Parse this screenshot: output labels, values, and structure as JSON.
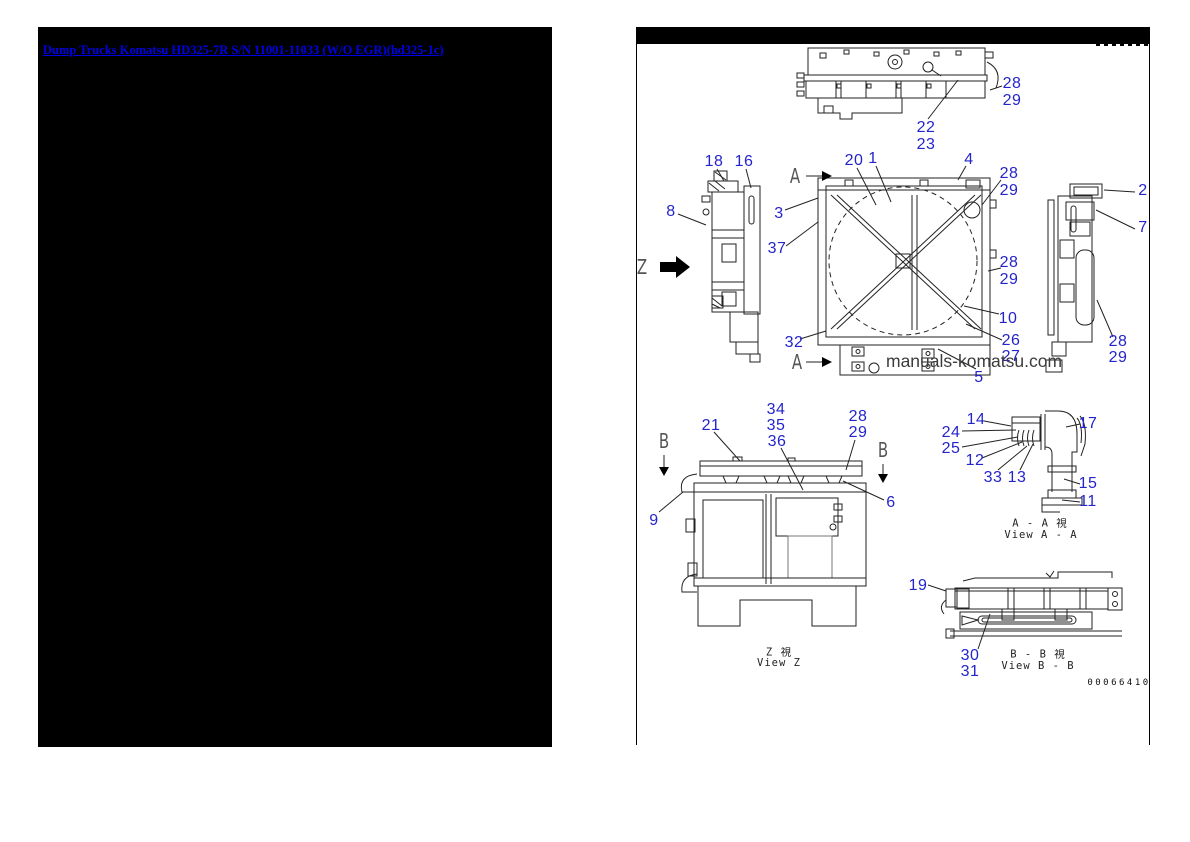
{
  "colors": {
    "callout_blue": "#2424cc",
    "link_blue": "#0000e6"
  },
  "left_page": {
    "link_text": "Dump Trucks Komatsu HD325-7R S/N 11001-11033 (W/O EGR)(hd325-1c)"
  },
  "right_page": {
    "watermark": "manuals-komatsu.com",
    "drawing_number": "00066410",
    "captions": {
      "z_jp": "Z   視",
      "z_en": "View Z",
      "aa_jp": "A - A   視",
      "aa_en": "View A - A",
      "bb_jp": "B - B   視",
      "bb_en": "View B - B"
    },
    "markers": {
      "a_top": "A",
      "a_bottom": "A",
      "z": "Z",
      "b_left": "B",
      "b_right": "B"
    }
  },
  "callouts": [
    {
      "t": "28"
    },
    {
      "t": "29"
    },
    {
      "t": "22"
    },
    {
      "t": "23"
    },
    {
      "t": "18"
    },
    {
      "t": "16"
    },
    {
      "t": "8"
    },
    {
      "t": "3"
    },
    {
      "t": "37"
    },
    {
      "t": "32"
    },
    {
      "t": "20"
    },
    {
      "t": "1"
    },
    {
      "t": "4"
    },
    {
      "t": "28"
    },
    {
      "t": "29"
    },
    {
      "t": "28"
    },
    {
      "t": "29"
    },
    {
      "t": "10"
    },
    {
      "t": "26"
    },
    {
      "t": "27"
    },
    {
      "t": "5"
    },
    {
      "t": "2"
    },
    {
      "t": "7"
    },
    {
      "t": "28"
    },
    {
      "t": "29"
    },
    {
      "t": "21"
    },
    {
      "t": "34"
    },
    {
      "t": "35"
    },
    {
      "t": "36"
    },
    {
      "t": "28"
    },
    {
      "t": "29"
    },
    {
      "t": "6"
    },
    {
      "t": "9"
    },
    {
      "t": "14"
    },
    {
      "t": "24"
    },
    {
      "t": "25"
    },
    {
      "t": "12"
    },
    {
      "t": "33"
    },
    {
      "t": "13"
    },
    {
      "t": "17"
    },
    {
      "t": "15"
    },
    {
      "t": "11"
    },
    {
      "t": "19"
    },
    {
      "t": "30"
    },
    {
      "t": "31"
    }
  ]
}
